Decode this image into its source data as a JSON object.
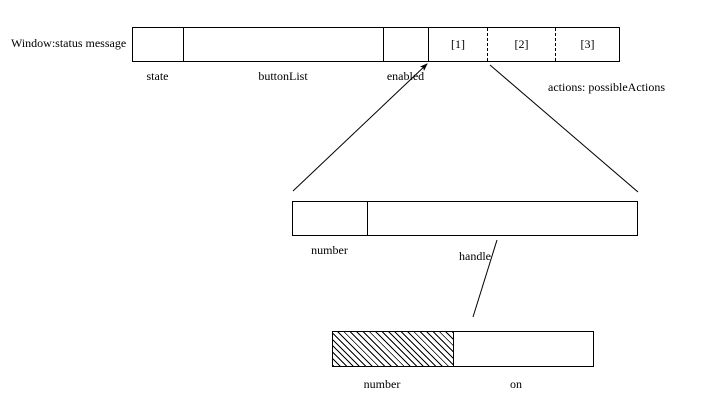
{
  "colors": {
    "ink": "#000000",
    "paper": "#ffffff"
  },
  "window_record": {
    "title_label": "Window:status message",
    "cells": [
      {
        "name": "state",
        "text": ""
      },
      {
        "name": "buttonList",
        "text": ""
      },
      {
        "name": "enabled",
        "text": ""
      },
      {
        "name": "action1",
        "text": "[1]"
      },
      {
        "name": "action2",
        "text": "[2]"
      },
      {
        "name": "action3",
        "text": "[3]"
      }
    ],
    "labels": {
      "state": "state",
      "button_list": "buttonList",
      "enabled": "enabled",
      "actions": "actions: possibleActions"
    }
  },
  "button_record": {
    "labels": {
      "number": "number",
      "handle": "handle"
    }
  },
  "handle_record": {
    "labels": {
      "number": "number",
      "on": "on"
    }
  }
}
